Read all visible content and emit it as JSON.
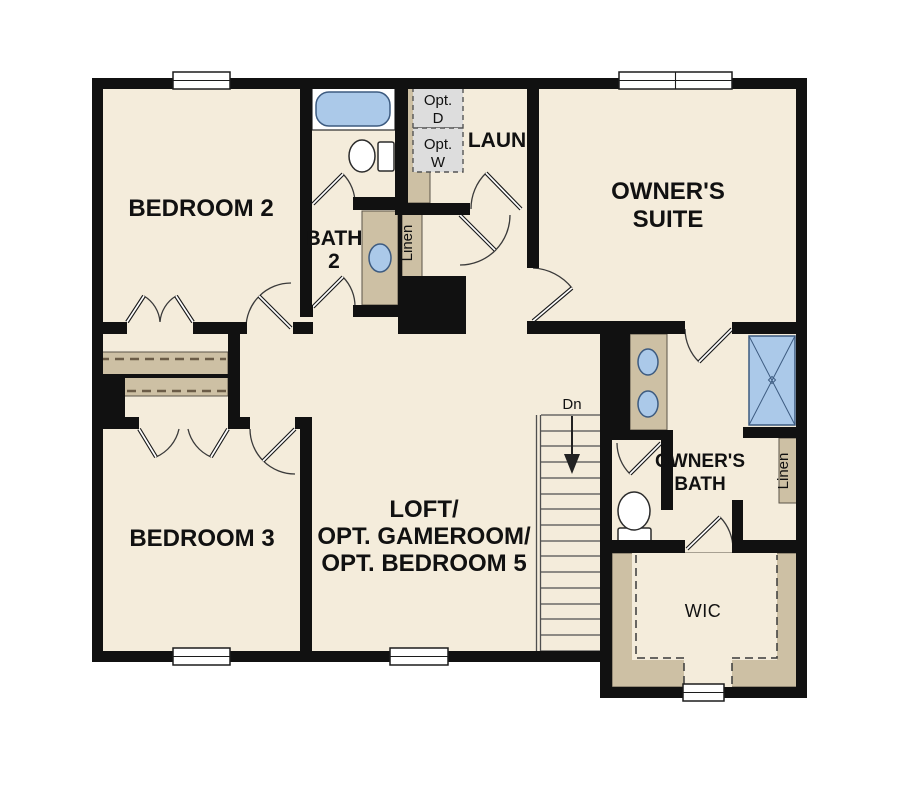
{
  "figure": {
    "type": "floor-plan",
    "floor": "second"
  },
  "colors": {
    "wall": "#111111",
    "floor": "#f4ecdb",
    "cabinet": "#cdc0a4",
    "cabinet_outline": "#5a5348",
    "fixture_blue": "#abc9e9",
    "fixture_outline": "#3d5b80",
    "optional_grey": "#dddddd",
    "window": "#ffffff",
    "dash": "#6b5c47"
  },
  "rooms": {
    "bedroom2": {
      "name": "BEDROOM 2"
    },
    "bath2": {
      "name_line1": "BATH",
      "name_line2": "2"
    },
    "laundry": {
      "name": "LAUN",
      "opt_dryer_line1": "Opt.",
      "opt_dryer_line2": "D",
      "opt_washer_line1": "Opt.",
      "opt_washer_line2": "W"
    },
    "owners_suite": {
      "name_line1": "OWNER'S",
      "name_line2": "SUITE"
    },
    "bedroom3": {
      "name": "BEDROOM 3"
    },
    "loft": {
      "name_line1": "LOFT/",
      "name_line2": "OPT. GAMEROOM/",
      "name_line3": "OPT. BEDROOM 5"
    },
    "owners_bath": {
      "name_line1": "OWNER'S",
      "name_line2": "BATH"
    },
    "wic": {
      "name": "WIC"
    },
    "hall_linen": {
      "name": "Linen"
    },
    "owners_linen": {
      "name": "Linen"
    },
    "stairs": {
      "direction_label": "Dn"
    }
  }
}
